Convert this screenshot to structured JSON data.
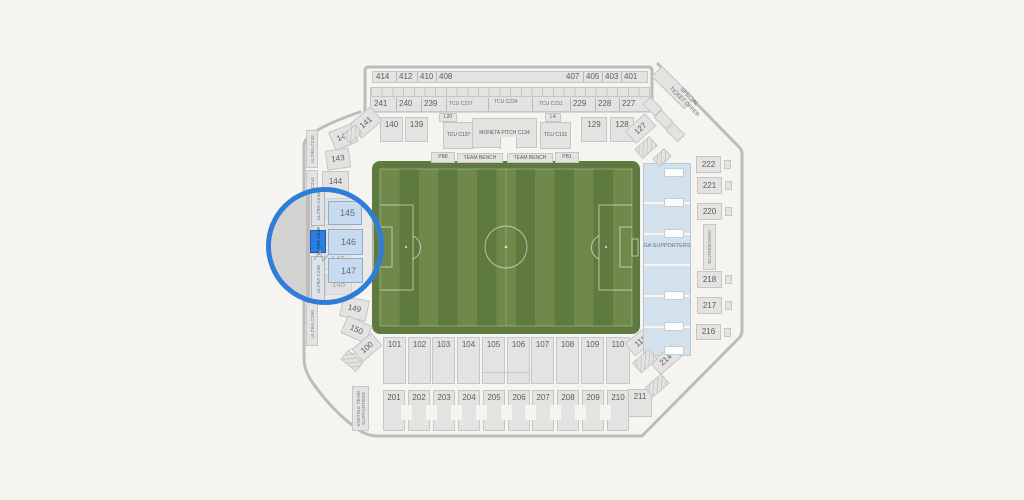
{
  "colors": {
    "bg": "#f5f4f1",
    "secFill": "#e4e3e1",
    "secBorder": "#c7c6c4",
    "wall": "#bdbcba",
    "txt": "#5c5c5c",
    "fieldDark": "#5f7a3e",
    "fieldLight": "#70894b",
    "ga": "#d3e1ed",
    "gaBorder": "#b5c9da",
    "ring": "#2f7cd9",
    "selected": "#2f7de1",
    "lensSecFill": "#c8daee",
    "lensSecBorder": "#8badd3"
  },
  "map": {
    "upper_left": [
      "414",
      "412",
      "410",
      "408"
    ],
    "upper_right": [
      "407",
      "405",
      "403",
      "401"
    ],
    "north200": [
      "241",
      "240",
      "239",
      "TCU C237",
      "TCU C234",
      "TCU C231",
      "229",
      "228",
      "227"
    ],
    "club": {
      "s140": "140",
      "s139": "139",
      "l20": "L20",
      "tcu_w": "TCU C137",
      "moneta": "MONETA PITCH C134",
      "tcu_e": "TCU C131",
      "l4": "L4",
      "s129": "129",
      "s128": "128"
    },
    "bench": {
      "pb8": "PB8",
      "bench_w": "TEAM BENCH",
      "bench_e": "TEAM BENCH",
      "pb1": "PB1"
    },
    "west": {
      "clubs": [
        "ULTRA C242",
        "ULTRA C244",
        "ULTRA C246",
        "ULTRA C248",
        "ULTRA C250"
      ],
      "sections": [
        "141",
        "142",
        "143",
        "144",
        "145",
        "146",
        "147",
        "148",
        "149",
        "150"
      ]
    },
    "south": {
      "row100": [
        "100",
        "101",
        "102",
        "103",
        "104",
        "105",
        "106",
        "107",
        "108",
        "109",
        "110",
        "111"
      ],
      "row200": [
        "201",
        "202",
        "203",
        "204",
        "205",
        "206",
        "207",
        "208",
        "209",
        "210",
        "211"
      ],
      "visiting1": "VISITING TEAM",
      "visiting2": "SUPPORTERS"
    },
    "east": {
      "sections": [
        "222",
        "221",
        "220",
        "218",
        "217",
        "216"
      ],
      "scoreboard": "SCOREBOARD",
      "ga": "GA SUPPORTERS",
      "c127": "127",
      "c214": "214"
    },
    "offer1": "SPECIAL",
    "offer2": "TICKET OFFER",
    "magnifier": {
      "above": "ULTRA C244",
      "selected": "ULTRA C246",
      "below": "ULTRA C248",
      "sections": [
        "145",
        "146",
        "147"
      ]
    }
  }
}
